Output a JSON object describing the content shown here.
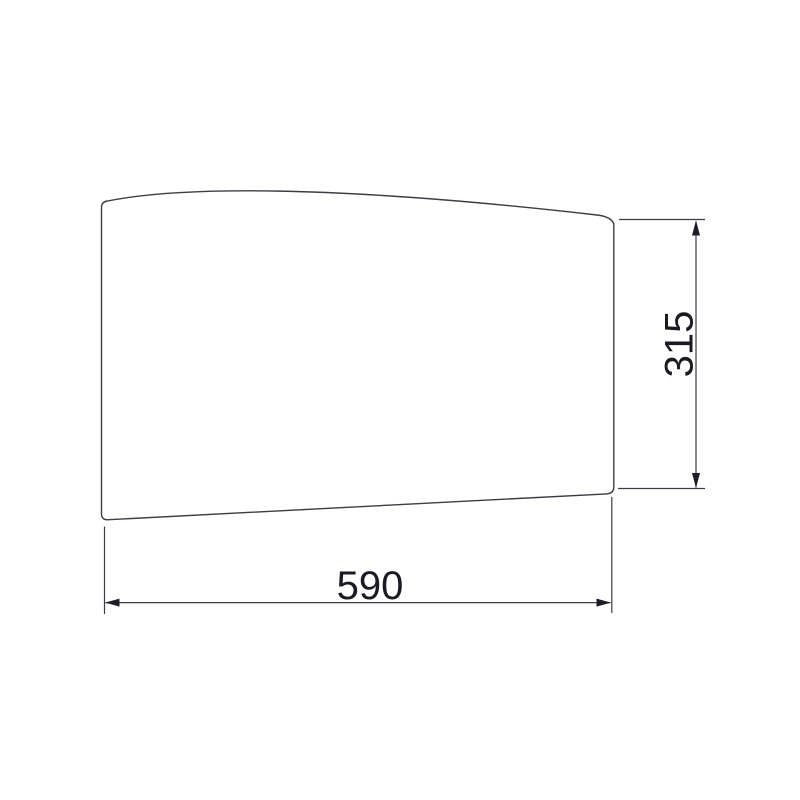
{
  "drawing": {
    "width_dim": {
      "value": "590"
    },
    "height_dim": {
      "value": "315"
    }
  },
  "colors": {
    "background": "#ffffff",
    "line": "#3c3c46",
    "arrow": "#1d1d28",
    "text": "#1a1a24"
  }
}
